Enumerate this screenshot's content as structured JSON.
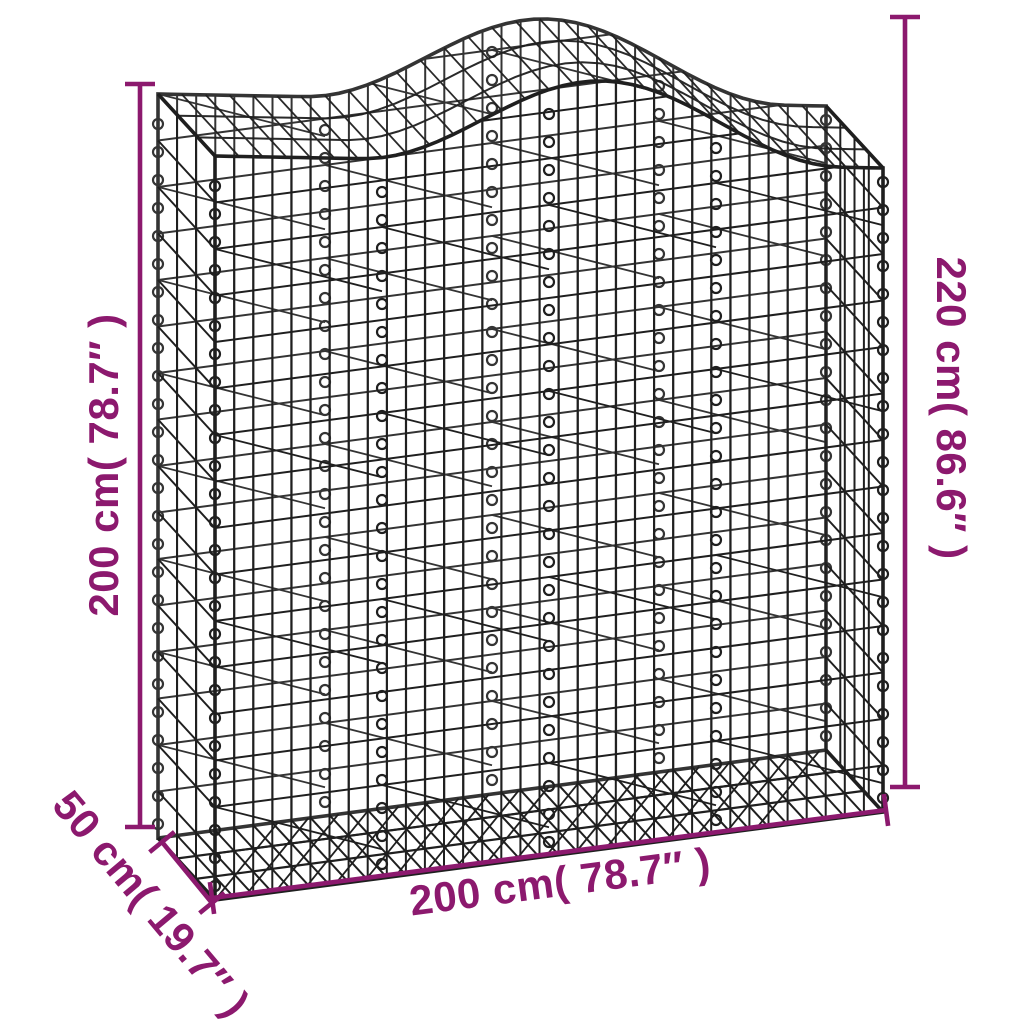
{
  "diagram": {
    "subject": "arched gabion wire mesh basket",
    "background_color": "#FFFFFF",
    "accent_color": "#8C196E",
    "wire_color": "#1F1F1F"
  },
  "dimensions": {
    "height_left": {
      "label": "200 cm( 78.7″ )",
      "value_cm": 200,
      "value_in": 78.7
    },
    "height_right": {
      "label": "220 cm( 86.6″ )",
      "value_cm": 220,
      "value_in": 86.6
    },
    "width_bottom": {
      "label": "200 cm( 78.7″ )",
      "value_cm": 200,
      "value_in": 78.7
    },
    "depth_left": {
      "label": "50 cm( 19.7″ )",
      "value_cm": 50,
      "value_in": 19.7
    }
  }
}
